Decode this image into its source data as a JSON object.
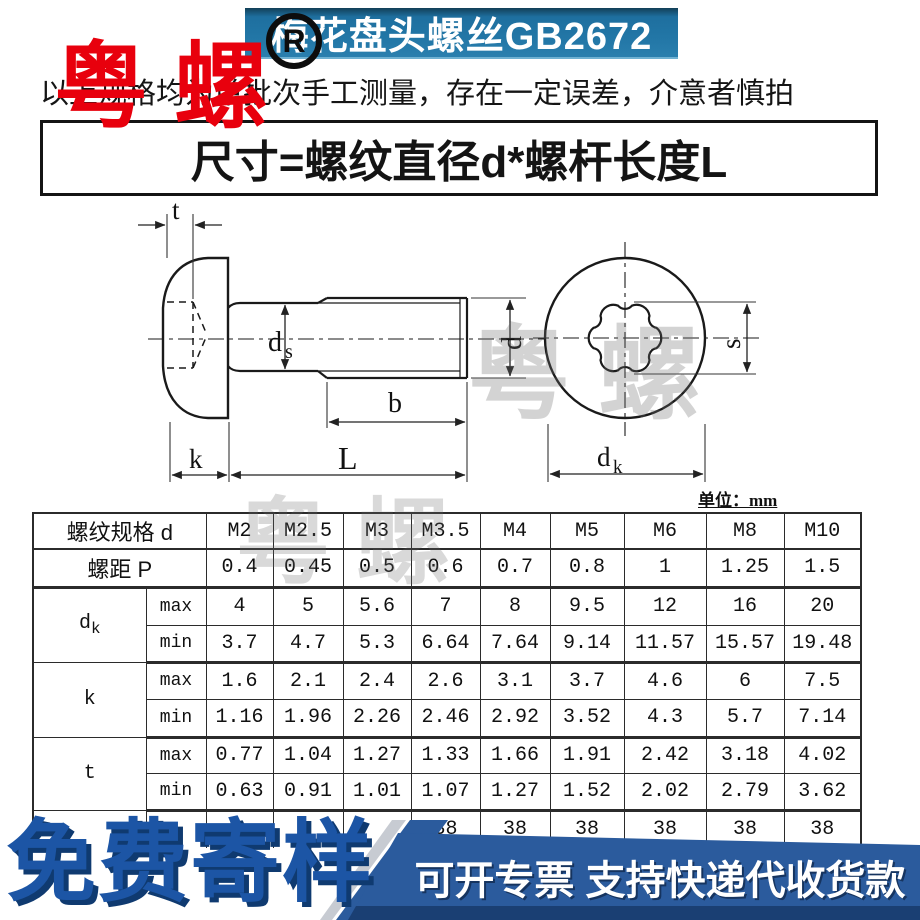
{
  "header": {
    "title": "梅花盘头螺丝GB2672",
    "registered_mark": "R",
    "banner_color": "#2276a6"
  },
  "watermark": {
    "text": "粤 螺",
    "red_color": "#e8000d"
  },
  "disclaimer": "以上规格均为单批次手工测量，存在一定误差，介意者慎拍",
  "size_formula": "尺寸=螺纹直径d*螺杆长度L",
  "drawing": {
    "labels": {
      "t": "t",
      "k": "k",
      "L": "L",
      "b": "b",
      "d": "d",
      "ds_main": "d",
      "ds_sub": "s",
      "s": "s",
      "dk_main": "d",
      "dk_sub": "k"
    },
    "unit_label": "单位：",
    "unit_value": "mm"
  },
  "table": {
    "spec_label": "螺纹规格 d",
    "pitch_label": "螺距 P",
    "max_label": "max",
    "min_label": "min",
    "row_labels": {
      "dk_main": "d",
      "dk_sub": "k",
      "k": "k",
      "t": "t"
    },
    "sizes": [
      "M2",
      "M2.5",
      "M3",
      "M3.5",
      "M4",
      "M5",
      "M6",
      "M8",
      "M10"
    ],
    "pitch": [
      "0.4",
      "0.45",
      "0.5",
      "0.6",
      "0.7",
      "0.8",
      "1",
      "1.25",
      "1.5"
    ],
    "dk_max": [
      "4",
      "5",
      "5.6",
      "7",
      "8",
      "9.5",
      "12",
      "16",
      "20"
    ],
    "dk_min": [
      "3.7",
      "4.7",
      "5.3",
      "6.64",
      "7.64",
      "9.14",
      "11.57",
      "15.57",
      "19.48"
    ],
    "k_max": [
      "1.6",
      "2.1",
      "2.4",
      "2.6",
      "3.1",
      "3.7",
      "4.6",
      "6",
      "7.5"
    ],
    "k_min": [
      "1.16",
      "1.96",
      "2.26",
      "2.46",
      "2.92",
      "3.52",
      "4.3",
      "5.7",
      "7.14"
    ],
    "t_max": [
      "0.77",
      "1.04",
      "1.27",
      "1.33",
      "1.66",
      "1.91",
      "2.42",
      "3.18",
      "4.02"
    ],
    "t_min": [
      "0.63",
      "0.91",
      "1.01",
      "1.07",
      "1.27",
      "1.52",
      "2.02",
      "2.79",
      "3.62"
    ],
    "partial_row": [
      "",
      "",
      "",
      "38",
      "38",
      "38",
      "38",
      "38",
      "38"
    ]
  },
  "footer": {
    "free_sample": "免费寄样",
    "promo": "可开专票 支持快递代收货款",
    "band_color": "#2b5b9d"
  }
}
